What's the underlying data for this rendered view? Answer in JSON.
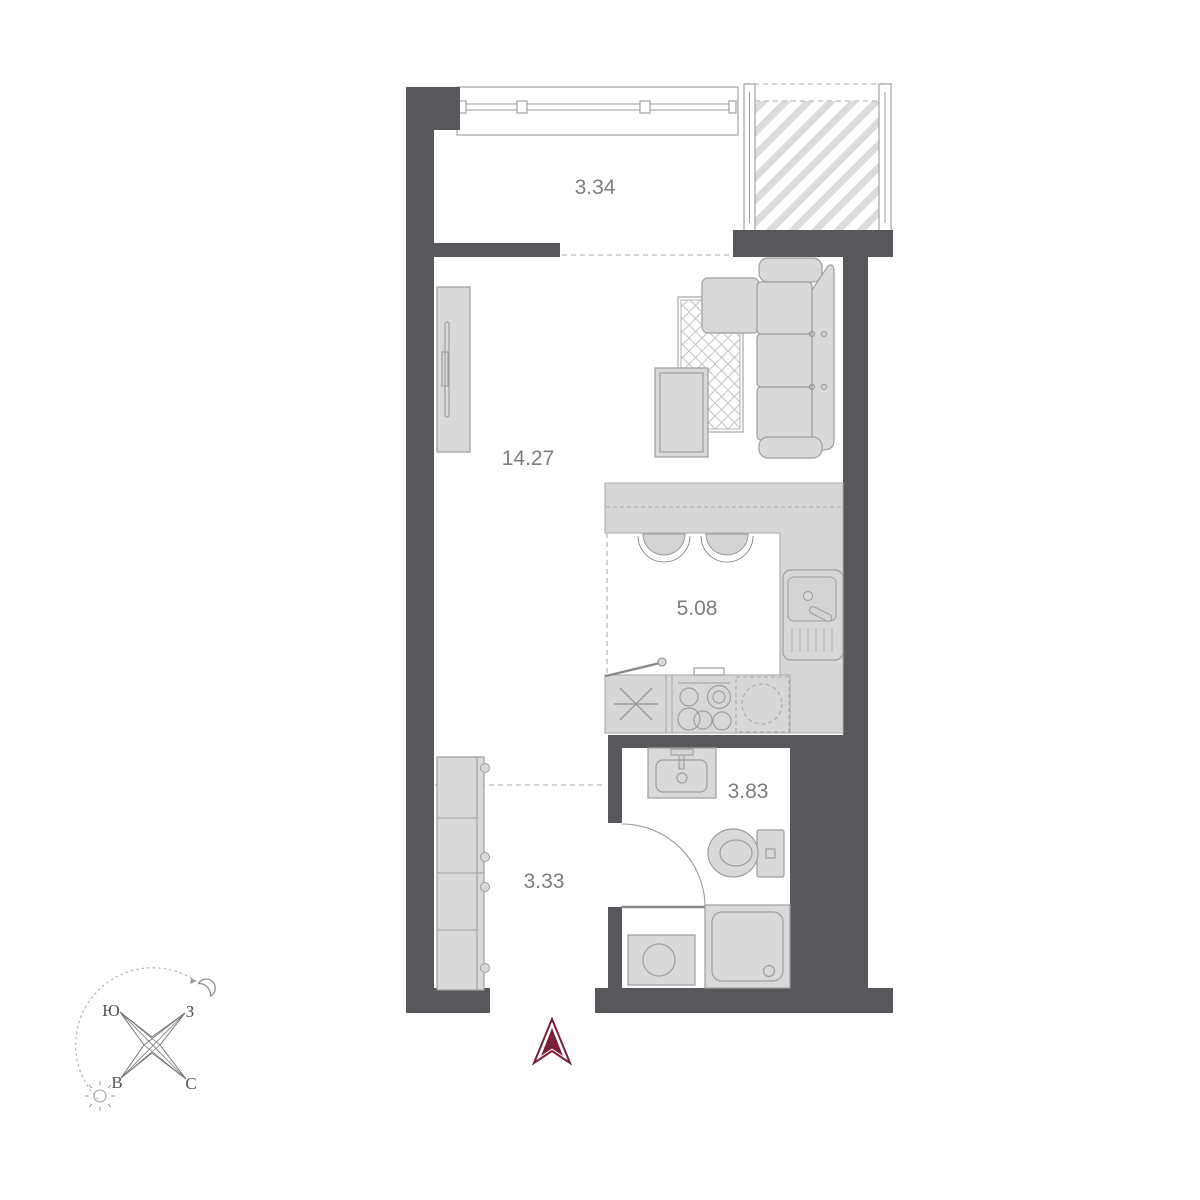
{
  "plan": {
    "title": "studio-apartment-floor-plan",
    "rooms": [
      {
        "id": "loggia",
        "area": "3.34"
      },
      {
        "id": "living-room",
        "area": "14.27"
      },
      {
        "id": "kitchen",
        "area": "5.08"
      },
      {
        "id": "bathroom",
        "area": "3.83"
      },
      {
        "id": "hallway",
        "area": "3.33"
      }
    ],
    "compass": {
      "south": "Ю",
      "west": "З",
      "east": "В",
      "north": "С"
    },
    "colors": {
      "wall": "#57575c",
      "furniture_fill": "#d9d9d9",
      "furniture_stroke": "#9e9e9e",
      "label": "#7d7d7d",
      "entrance_arrow": "#7a2038",
      "dashed_line": "#c6c6c6",
      "hatch": "#dcdcdc"
    }
  }
}
